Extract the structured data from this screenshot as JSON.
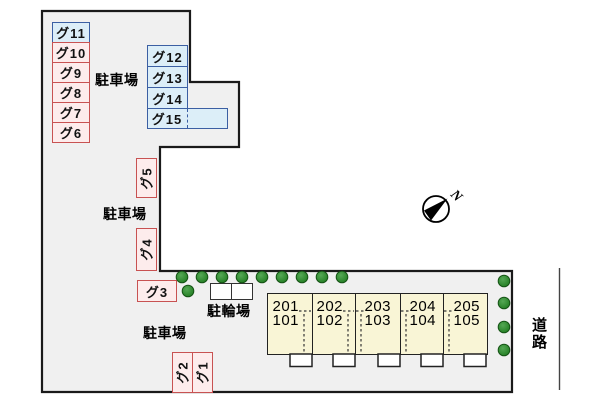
{
  "plan": {
    "parking_area_label": "駐車場",
    "bicycle_area_label": "駐輪場",
    "road_label": "道路",
    "compass_north": "N"
  },
  "parking_spaces": [
    {
      "id": "g11",
      "label": "グ11",
      "color": "blue"
    },
    {
      "id": "g10",
      "label": "グ10",
      "color": "pink"
    },
    {
      "id": "g9",
      "label": "グ9",
      "color": "pink"
    },
    {
      "id": "g8",
      "label": "グ8",
      "color": "pink"
    },
    {
      "id": "g7",
      "label": "グ7",
      "color": "pink"
    },
    {
      "id": "g6",
      "label": "グ6",
      "color": "pink"
    },
    {
      "id": "g12",
      "label": "グ12",
      "color": "blue"
    },
    {
      "id": "g13",
      "label": "グ13",
      "color": "blue"
    },
    {
      "id": "g14",
      "label": "グ14",
      "color": "blue"
    },
    {
      "id": "g15",
      "label": "グ15",
      "color": "blue"
    },
    {
      "id": "g5",
      "label": "グ5",
      "color": "pink"
    },
    {
      "id": "g4",
      "label": "グ4",
      "color": "pink"
    },
    {
      "id": "g3",
      "label": "グ3",
      "color": "pink"
    },
    {
      "id": "g2",
      "label": "グ2",
      "color": "pink"
    },
    {
      "id": "g1",
      "label": "グ1",
      "color": "pink"
    }
  ],
  "building_units": [
    {
      "upper": "201",
      "lower": "101"
    },
    {
      "upper": "202",
      "lower": "102"
    },
    {
      "upper": "203",
      "lower": "103"
    },
    {
      "upper": "204",
      "lower": "104"
    },
    {
      "upper": "205",
      "lower": "105"
    }
  ],
  "colors": {
    "lot_fill": "#f0f0f0",
    "lot_border": "#1a1a1a",
    "pink_fill": "#fdecec",
    "pink_border": "#c85252",
    "blue_fill": "#dceef8",
    "blue_border": "#3b5fa3",
    "building_fill": "#f9f5d6",
    "tree_green": "#2e8b2e"
  }
}
